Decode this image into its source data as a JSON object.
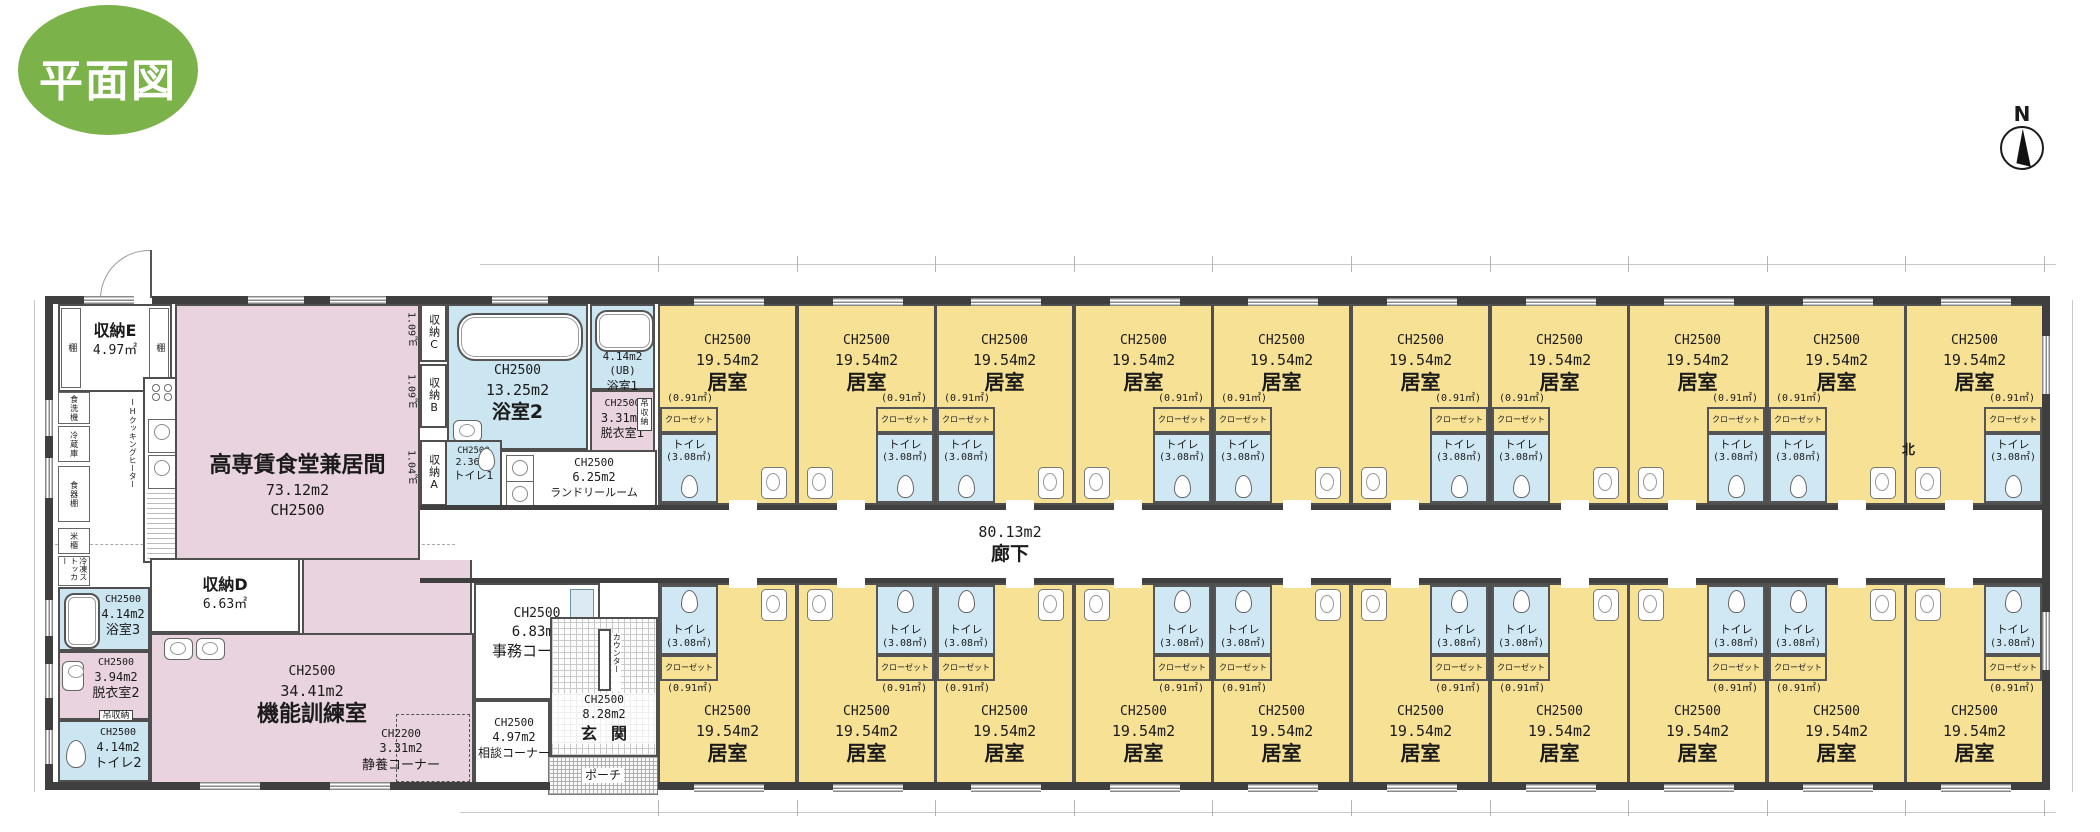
{
  "badge": {
    "label": "平面図"
  },
  "compass": {
    "label": "N"
  },
  "colors": {
    "badge_green": "#7bb249",
    "room_yellow": "#f6e195",
    "wet_blue": "#cbe5f1",
    "common_pink": "#e9d3df",
    "wall": "#3f3f3f"
  },
  "plan": {
    "room": {
      "ch": "CH2500",
      "area": "19.54m2",
      "name": "居室",
      "closet": "クローゼット",
      "closet_area": "(0.91㎡)",
      "toilet": "トイレ",
      "toilet_area": "(3.08㎡)"
    },
    "top_rooms": [
      {
        "side": "left"
      },
      {
        "side": "right"
      },
      {
        "side": "left"
      },
      {
        "side": "right"
      },
      {
        "side": "left"
      },
      {
        "side": "right"
      },
      {
        "side": "left"
      },
      {
        "side": "right"
      },
      {
        "side": "left"
      },
      {
        "side": "right"
      }
    ],
    "bottom_rooms": [
      {
        "side": "left"
      },
      {
        "side": "right"
      },
      {
        "side": "left"
      },
      {
        "side": "right"
      },
      {
        "side": "left"
      },
      {
        "side": "right"
      },
      {
        "side": "left"
      },
      {
        "side": "right"
      },
      {
        "side": "left"
      },
      {
        "side": "right"
      }
    ],
    "corridor": {
      "area": "80.13m2",
      "name": "廊下"
    },
    "north_note": "北",
    "left": {
      "storage_e": {
        "name": "収納E",
        "area": "4.97㎡"
      },
      "shelf": "棚",
      "kitchen": {
        "dishwasher": "食洗機",
        "fridge": "冷蔵庫",
        "cupboard": "食器棚",
        "rice_bin": "米櫃",
        "freezer": "冷凍ストッカー",
        "ih": "IHクッキングヒーター"
      },
      "dining": {
        "name": "高専賃食堂兼居間",
        "area": "73.12m2",
        "ch": "CH2500"
      },
      "storage_c": {
        "name": "収納C",
        "area": "1.09㎡"
      },
      "storage_b": {
        "name": "収納B",
        "area": "1.09㎡"
      },
      "storage_a": {
        "name": "収納A",
        "area": "1.04㎡"
      },
      "bath2": {
        "ch": "CH2500",
        "area": "13.25m2",
        "name": "浴室2"
      },
      "bath1": {
        "area": "4.14m2",
        "ub": "(UB)",
        "name": "浴室1"
      },
      "dress1": {
        "ch": "CH2500",
        "area": "3.31m2",
        "name": "脱衣室1",
        "tag": "吊収納"
      },
      "toilet1": {
        "ch": "CH2500",
        "area": "2.36m2",
        "name": "トイレ1"
      },
      "laundry": {
        "ch": "CH2500",
        "area": "6.25m2",
        "name": "ランドリールーム"
      },
      "locker": "収納ロッカー",
      "office": {
        "ch": "CH2500",
        "area": "6.83m2",
        "name": "事務コーナー"
      },
      "storage_d": {
        "name": "収納D",
        "area": "6.63㎡"
      },
      "training": {
        "ch": "CH2500",
        "area": "34.41m2",
        "name": "機能訓練室"
      },
      "rest": {
        "ch": "CH2200",
        "area": "3.31m2",
        "name": "静養コーナー"
      },
      "consult": {
        "ch": "CH2500",
        "area": "4.97m2",
        "name": "相談コーナー"
      },
      "bath3": {
        "ch": "CH2500",
        "area": "4.14m2",
        "name": "浴室3"
      },
      "dress2": {
        "ch": "CH2500",
        "area": "3.94m2",
        "name": "脱衣室2",
        "tag": "吊収納"
      },
      "toilet2": {
        "ch": "CH2500",
        "area": "4.14m2",
        "name": "トイレ2"
      },
      "entrance": {
        "ch": "CH2500",
        "area": "8.28m2",
        "name": "玄関",
        "counter": "カウンター"
      },
      "porch": {
        "name": "ポーチ"
      }
    }
  }
}
